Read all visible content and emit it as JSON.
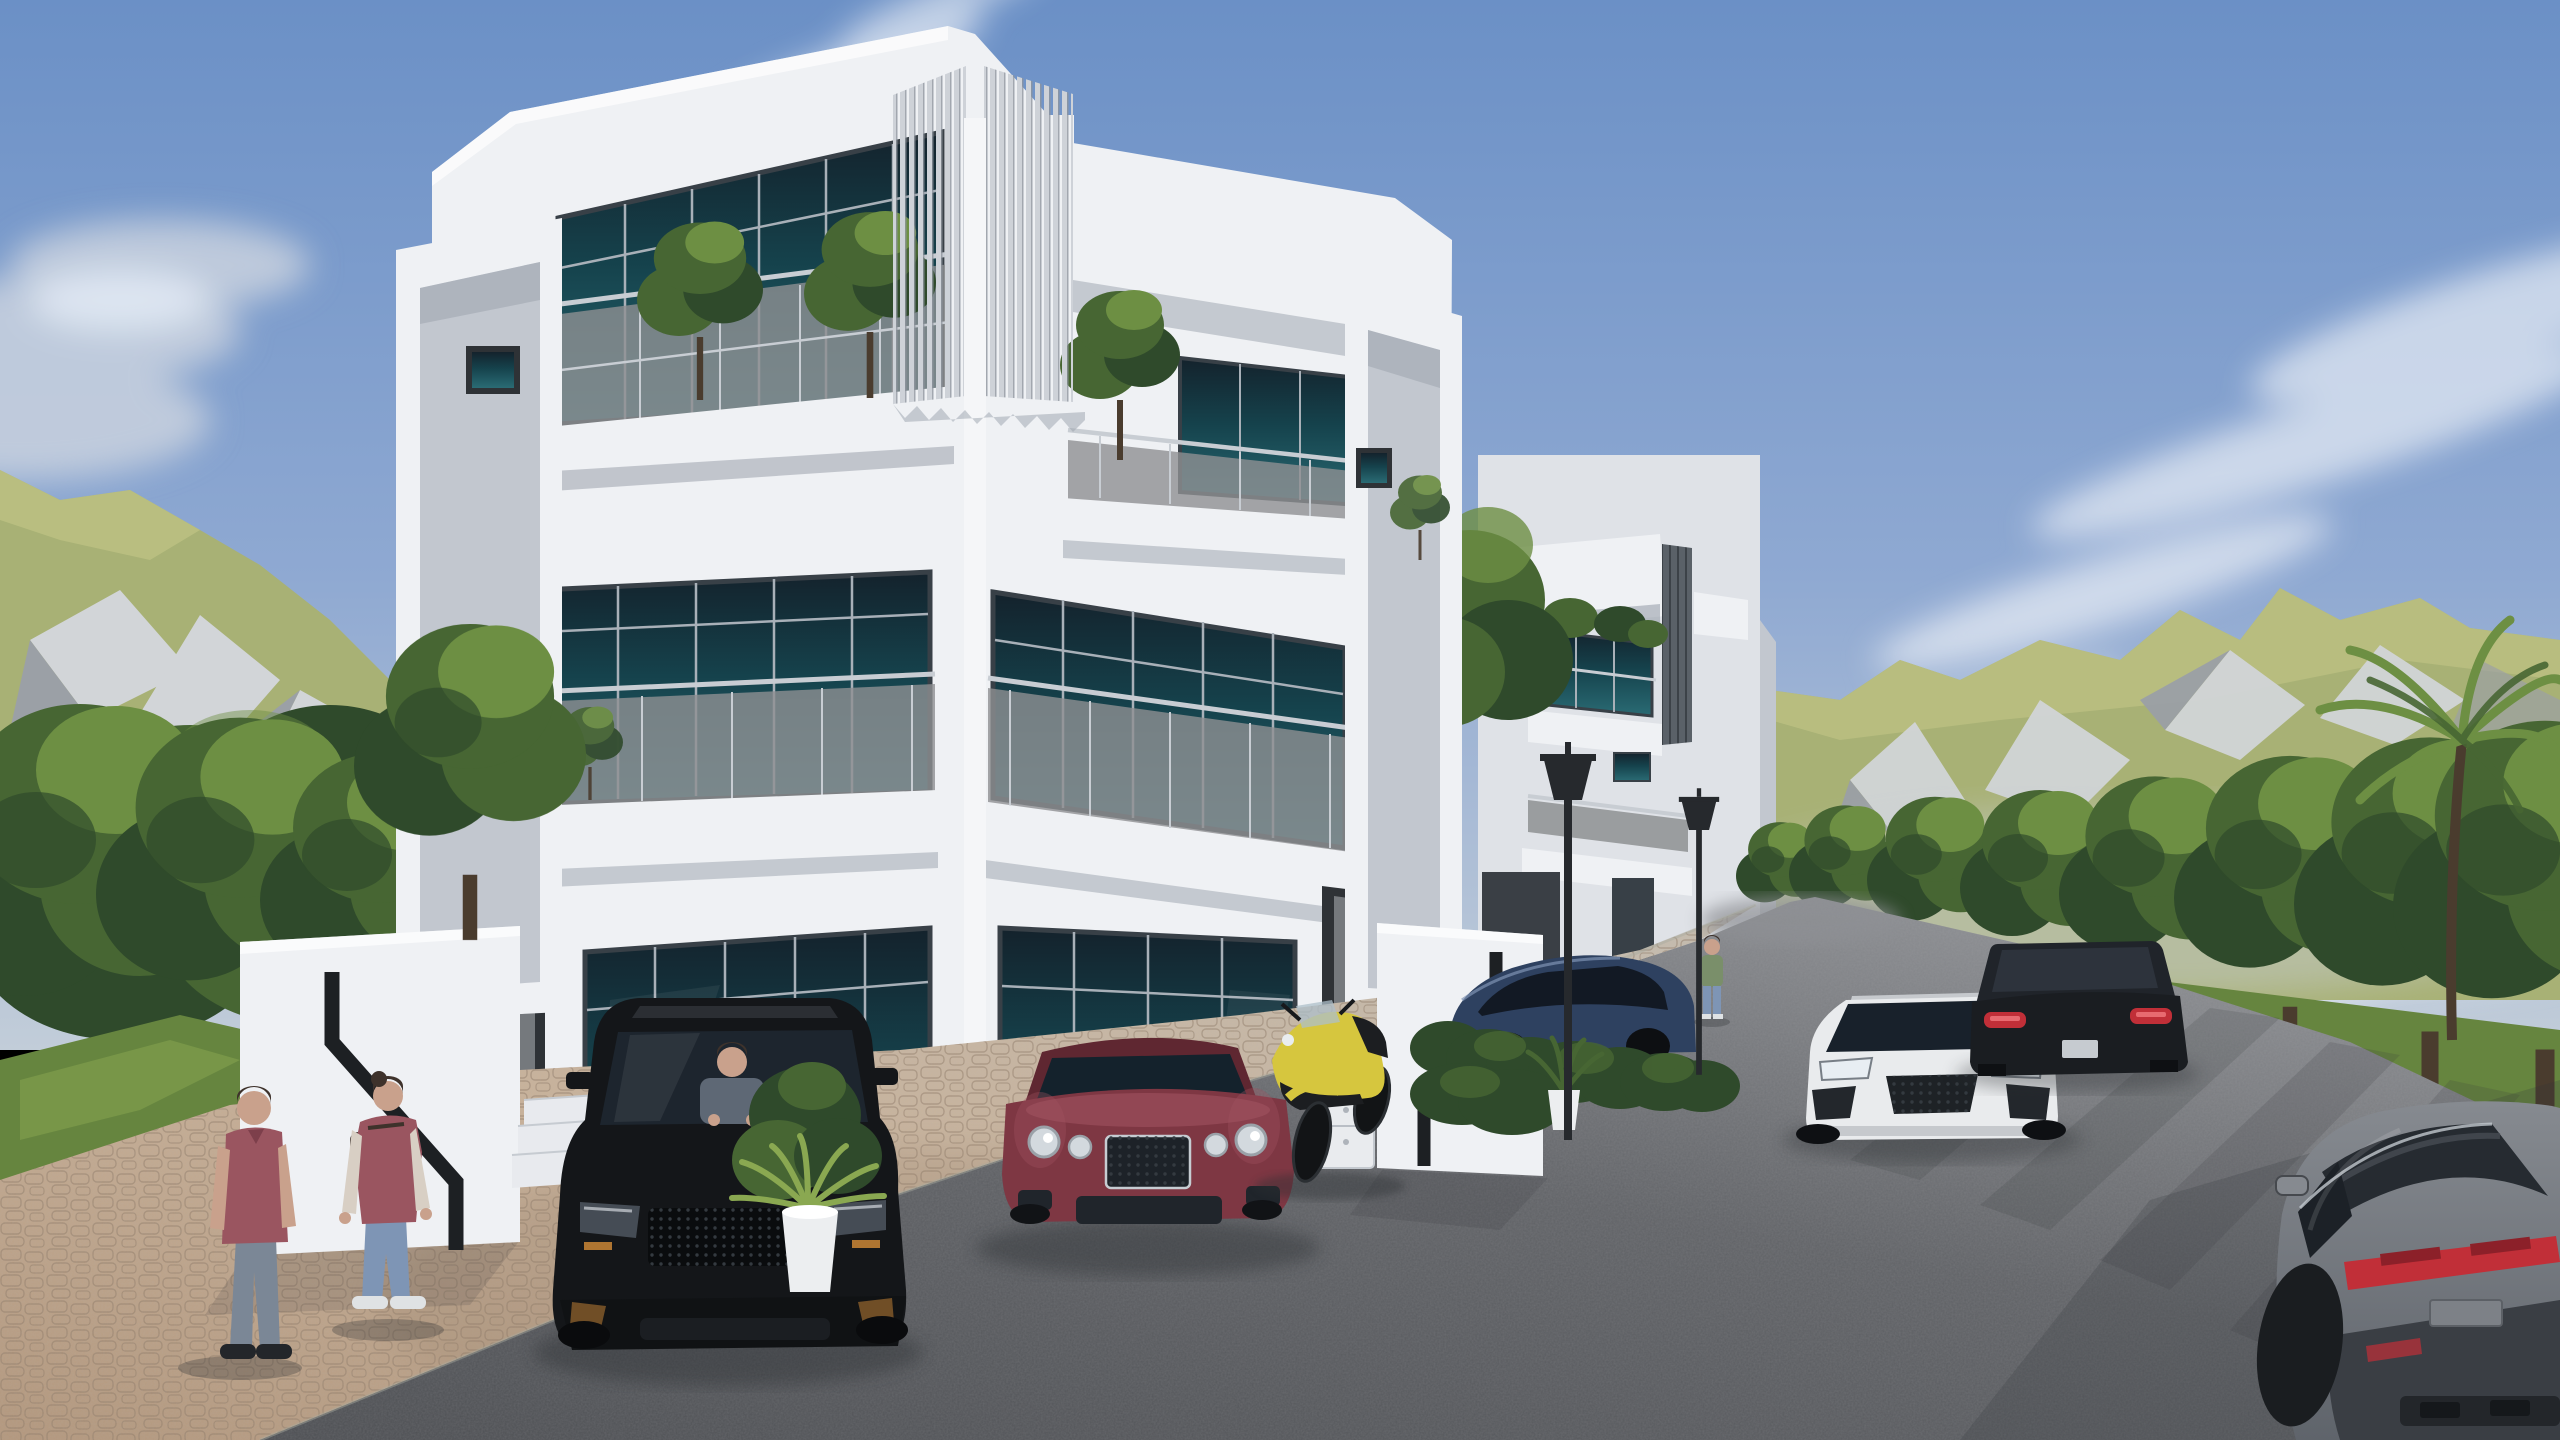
{
  "scene": {
    "title": "Modern duplex villa exterior — 3D architectural rendering",
    "description": "Daytime render of a white three-storey modern duplex villa with teal glass, balconies and vertical louver screens; black SUV, maroon coupe and yellow motorcycle parked on a brick driveway; white sports car and dark SUV on a curving asphalt road lined with trees; green rocky mountains and blue sky with soft clouds.",
    "labels": {
      "sky": "Sky",
      "clouds": "Clouds",
      "mountain_left": "Rocky mountain (left)",
      "mountain_right": "Mountain ridge (right)",
      "forest_left": "Trees (left)",
      "tree_row": "Roadside trees (right)",
      "gap_trees": "Trees between villas",
      "palm": "Palm tree",
      "road": "Asphalt road",
      "driveway": "Brick paver driveway",
      "grass": "Grass",
      "building_main": "Modern duplex villa",
      "unit_left": "Left unit",
      "unit_right": "Right unit",
      "louvers": "Vertical louver screen",
      "balcony": "Balcony with glass railing",
      "balcony_trees": "Balcony trees",
      "portal_left": "Projecting frame (left end)",
      "portal_right": "Projecting frame (right end)",
      "building_second": "Second villa",
      "side_wall": "Low boundary wall",
      "gate_left": "Entry gate wall with stair groove (left)",
      "gate_right": "Entry gate wall with stair groove (right)",
      "steps": "Entry steps",
      "door": "Entry door",
      "window": "Teal glass window",
      "stairs_inside": "Interior staircase silhouette",
      "cabinet": "Outdoor cabinet",
      "pot_palm": "Potted palm plant",
      "pot_fern": "Potted fern",
      "hedge": "Hedge",
      "lamp": "Street lamp",
      "suv": "Black SUV",
      "driver": "Driver",
      "coupe": "Maroon luxury coupe",
      "moto": "Yellow sport motorcycle",
      "car_blue": "Dark blue parked car",
      "car_white_small": "White parked car",
      "audi": "White sports car on road",
      "mb": "Dark SUV driving away",
      "panamera": "Gray sedan (foreground right)",
      "man": "Man in red polo",
      "woman": "Woman with backpack",
      "walker": "Person walking",
      "shadow": "Shadow"
    }
  },
  "colors": {
    "sky_top": "#6b90c6",
    "sky_mid": "#8fa9d2",
    "sky_low": "#c2cdd9",
    "cloud_bright": "#f2f5f9",
    "cloud_soft": "#dfe6ef",
    "cloud_gray": "#c9d2de",
    "mtn_grass": "#a8b175",
    "mtn_grass_light": "#bcc182",
    "mtn_rock": "#d2d5d8",
    "mtn_rock_shadow": "#9ba0a6",
    "mtn_haze": "#c7ccd4",
    "tree_dark": "#2f4a2b",
    "tree_mid": "#476633",
    "tree_light": "#6d8f43",
    "tree_sun": "#8fae55",
    "trunk": "#4a3c2e",
    "grass": "#66853f",
    "grass_light": "#8aa851",
    "road": "#606266",
    "road_dark": "#4c4e52",
    "road_light": "#8e9094",
    "road_shadow": "#33363a",
    "paver": "#b3977c",
    "paver_light": "#c9b198",
    "paver_far": "#c6bcad",
    "paver_line": "#8f7a66",
    "white_wall": "#eff1f4",
    "wall_shade": "#dfe2e7",
    "wall_dark": "#c2c7cf",
    "eave_shadow": "#9aa1ab",
    "divider": "#f5f6f8",
    "glass_teal": "#15424c",
    "glass_teal_light": "#2a6b74",
    "glass_dark": "#14222c",
    "frame_dark": "#384047",
    "mullion": "#a8b0b8",
    "balcony_glass": "#8e9092",
    "rail": "#c8cdd3",
    "louver": "#ced2d8",
    "louver_gap": "#8e959e",
    "louver_dark": "#5a6168",
    "door_gray": "#75797d",
    "door_frame": "#2e3236",
    "step_white": "#e8eaee",
    "suv_body": "#141619",
    "suv_glass": "#1d252e",
    "accent_amber": "#c08034",
    "bentley": "#7e3743",
    "bentley_light": "#a05260",
    "bentley_dark": "#5f2731",
    "chrome": "#c6ccd2",
    "moto_yellow": "#d6c63e",
    "moto_dark": "#1c1e21",
    "audi_white": "#e9ebed",
    "audi_shade": "#c6c9cd",
    "mb_body": "#1a1d21",
    "taillight": "#c12f38",
    "porsche_blue": "#2e4160",
    "pan_body": "#868a90",
    "pan_dark": "#5f646b",
    "pan_glass": "#262b31",
    "lamp": "#26292d",
    "pot_white": "#eceef0",
    "skin": "#c9a18c",
    "hair_dark": "#3e322b",
    "polo_red": "#9a5560",
    "jeans": "#7b8796",
    "jeans_blue": "#7e95b5",
    "cream": "#d8cfc4",
    "shoe_dark": "#23262a",
    "shoe_white": "#dfe2e4",
    "green_tee": "#7a8f6a",
    "shadow": "#2c2f33"
  }
}
